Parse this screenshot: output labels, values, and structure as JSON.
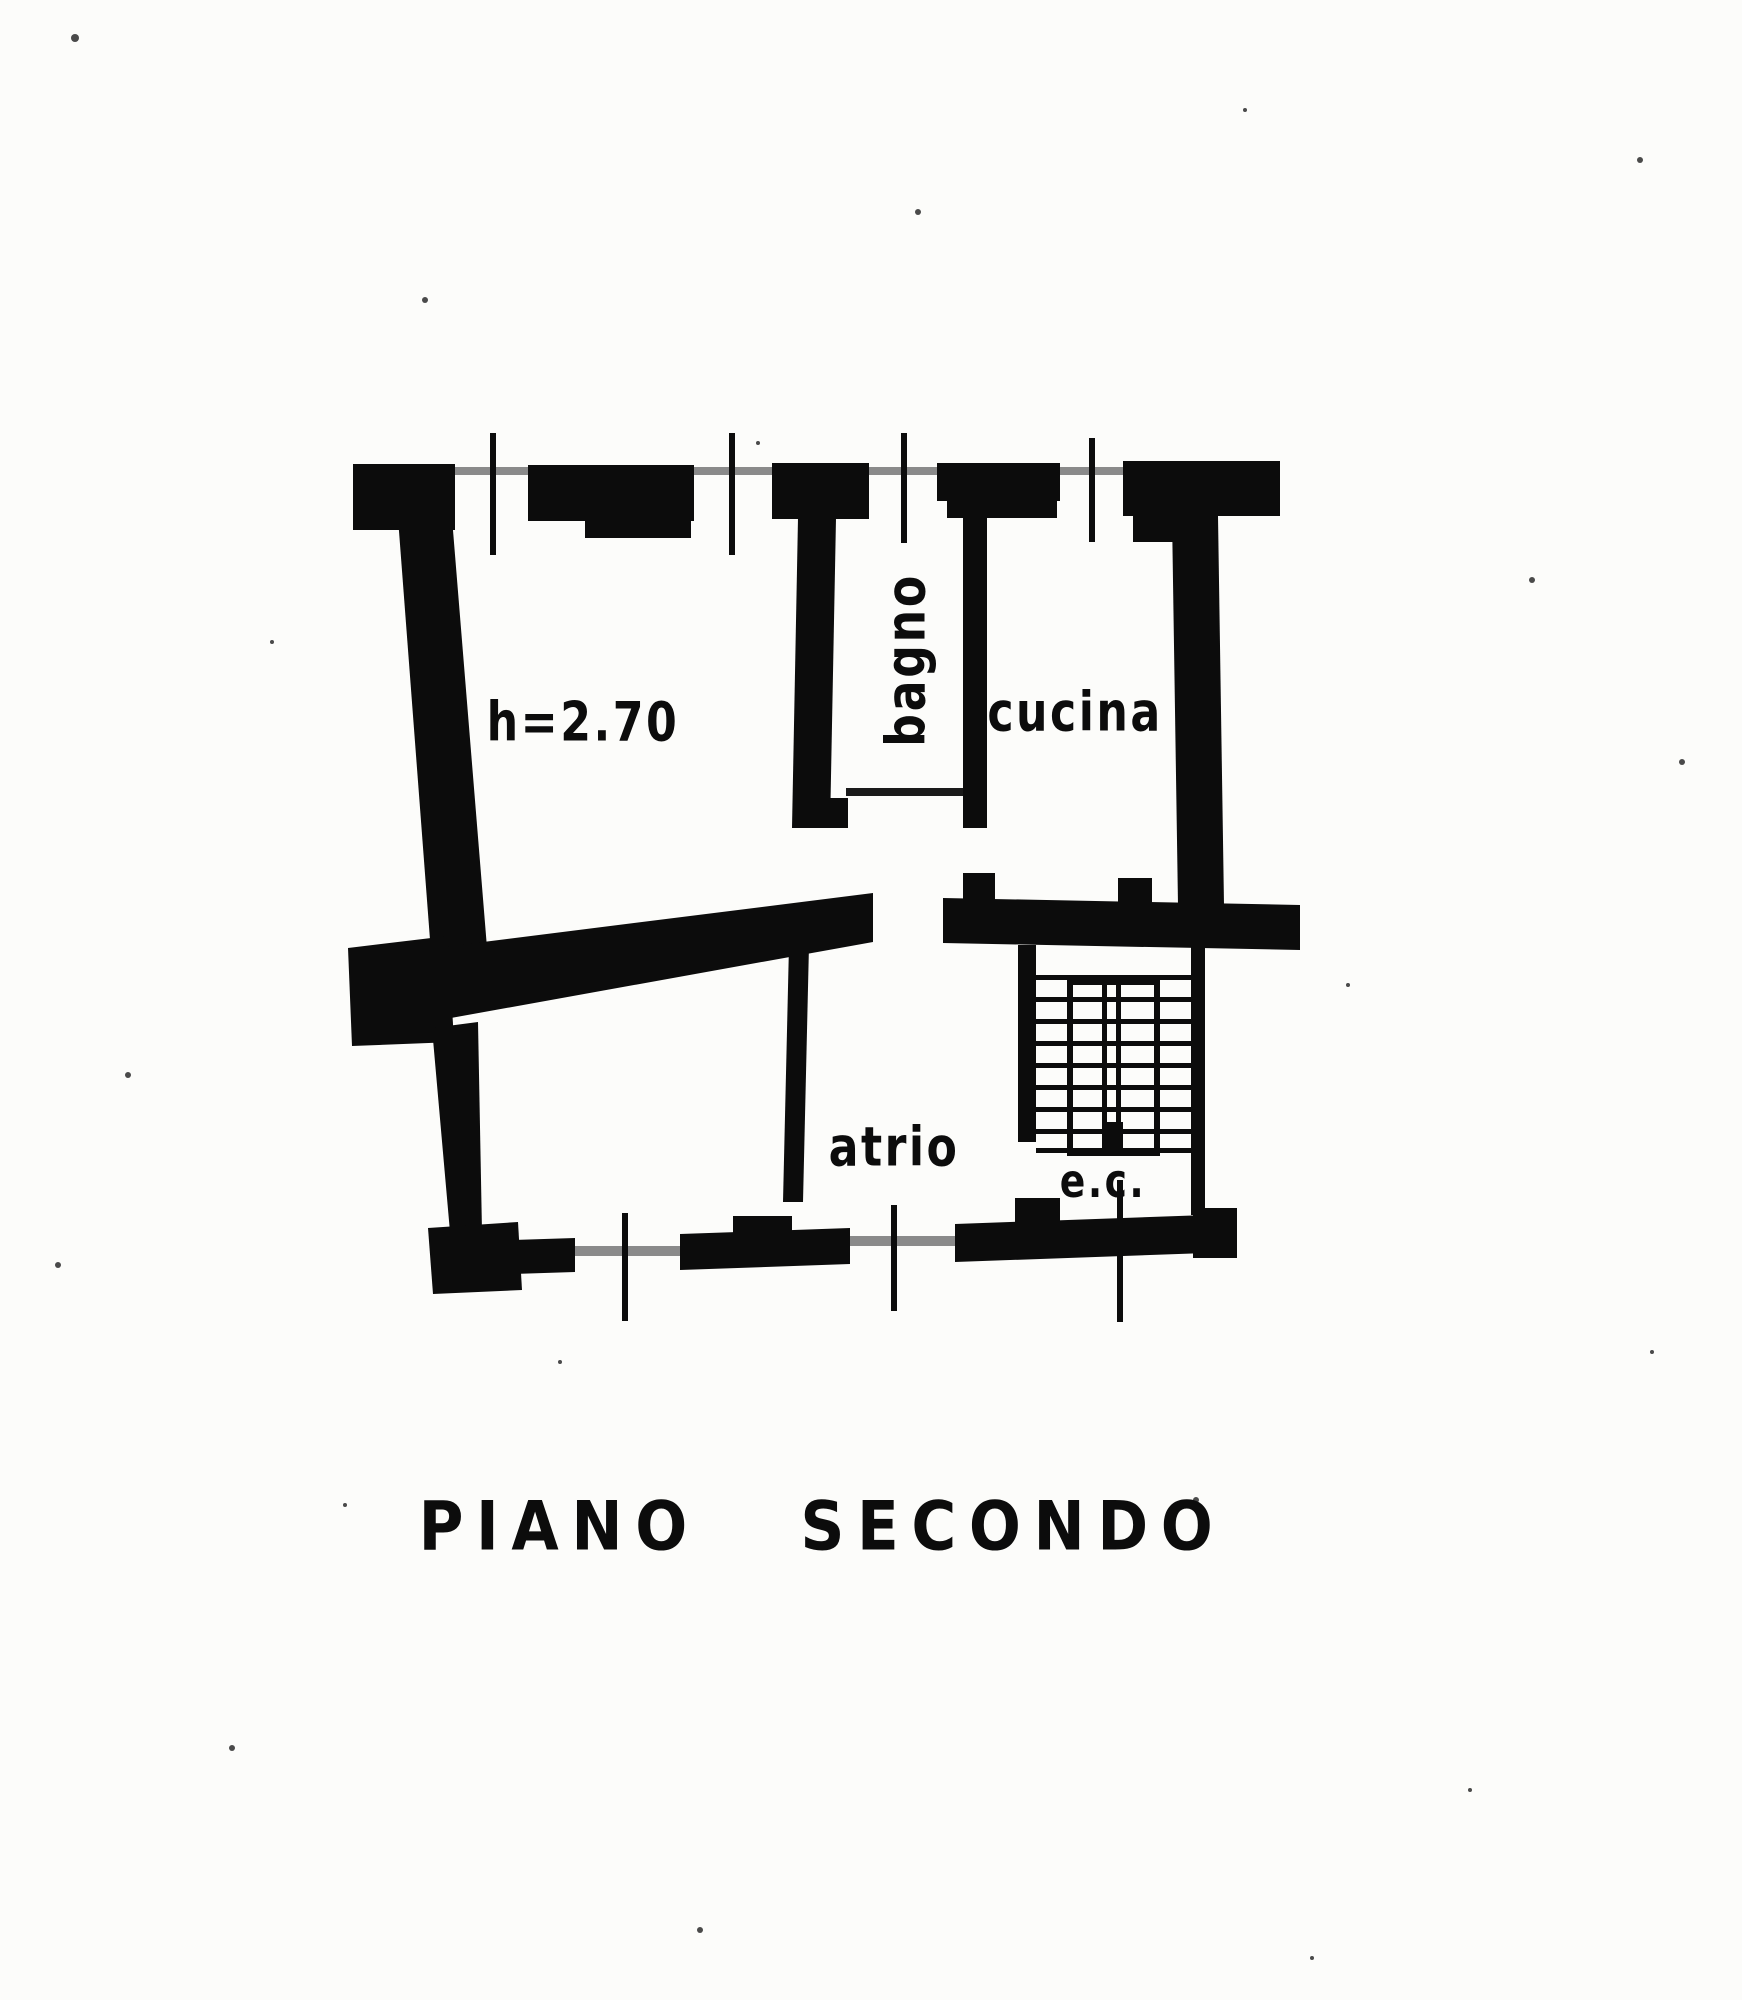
{
  "document": {
    "kind": "scanned apartment floor plan",
    "title": "PIANO SECONDO",
    "room_labels": {
      "main_room_height": "h=2.70",
      "bathroom": "bagno",
      "kitchen": "cucina",
      "hall": "atrio",
      "stairwell": "e.c."
    },
    "colors": {
      "ink": "#0c0c0c",
      "paper": "#fcfcfa",
      "faint_line": "#8a8a8a"
    }
  }
}
